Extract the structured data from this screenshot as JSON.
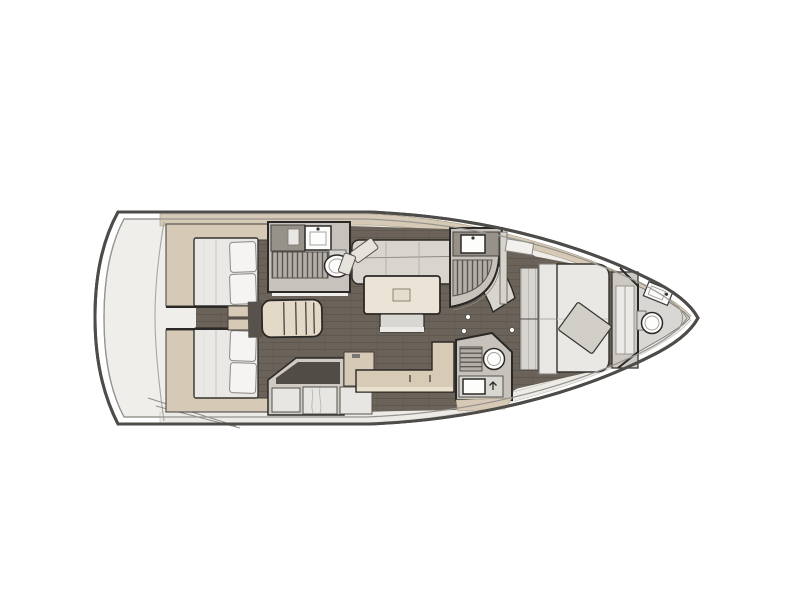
{
  "canvas": {
    "width": 800,
    "height": 600
  },
  "plan": {
    "type": "sailing-yacht-interior-layout-plan",
    "orientation": "bow-right-stern-left",
    "rooms": [
      {
        "name": "transom-platform",
        "fixtures": [
          "curved-transom-seam",
          "hull-chine-lines"
        ]
      },
      {
        "name": "aft-cabin-top",
        "fixtures": [
          "double-berth",
          "pillow",
          "pillow",
          "side-cabinet"
        ]
      },
      {
        "name": "aft-cabin-bottom",
        "fixtures": [
          "double-berth",
          "pillow",
          "pillow",
          "side-cabinet"
        ]
      },
      {
        "name": "companionway",
        "fixtures": [
          "entry-steps"
        ]
      },
      {
        "name": "aft-head-top",
        "fixtures": [
          "vanity-counter",
          "sink",
          "shower-grate",
          "toilet"
        ]
      },
      {
        "name": "saloon",
        "fixtures": [
          "u-shaped-sofa",
          "corner-cushions",
          "dining-table",
          "movable-stool"
        ]
      },
      {
        "name": "galley",
        "fixtures": [
          "l-shaped-counter",
          "sink-well",
          "island-unit",
          "front-lockers"
        ]
      },
      {
        "name": "settee-bench",
        "fixtures": [
          "l-shaped-bench"
        ]
      },
      {
        "name": "aft-head-bottom",
        "fixtures": [
          "shower-grate",
          "toilet",
          "sink",
          "faucet"
        ]
      },
      {
        "name": "mid-shower-room",
        "fixtures": [
          "vanity-counter",
          "sink",
          "shower-grate",
          "curved-glass-door"
        ]
      },
      {
        "name": "forward-cabin",
        "fixtures": [
          "island-berth",
          "headboard-pillows",
          "angled-cushion",
          "wardrobe",
          "deck-hatch",
          "door-knob"
        ]
      },
      {
        "name": "bow-head",
        "fixtures": [
          "sink",
          "toilet",
          "cistern",
          "bulkhead"
        ]
      }
    ]
  },
  "colors": {
    "background": "#ffffff",
    "hull_line": "#4e4c49",
    "hull_inner_line": "#96948f",
    "hull_fill": "#ffffff",
    "interior": "#f0eeea",
    "deck_top": "#d6cab6",
    "deck_bottom": "#edebe6",
    "floor": "#6b6359",
    "floor_seam": "#5d564d",
    "cabinet_beige": "#d6c9b5",
    "bench_beige": "#d8cbb5",
    "mattress": "#e9e8e5",
    "pillow": "#f5f4f2",
    "sofa": "#d8d5cf",
    "table": "#ebe3d5",
    "stool": "#d9d7d2",
    "head_wall": "#c7c3bc",
    "counter_dark": "#96928a",
    "grate": "#b3afa8",
    "grate_slat": "#5a564f",
    "fixture_white": "#fdfdfc",
    "outline": "#2b2927",
    "galley_front": "#e7e6e3",
    "well_dark": "#514c45"
  }
}
